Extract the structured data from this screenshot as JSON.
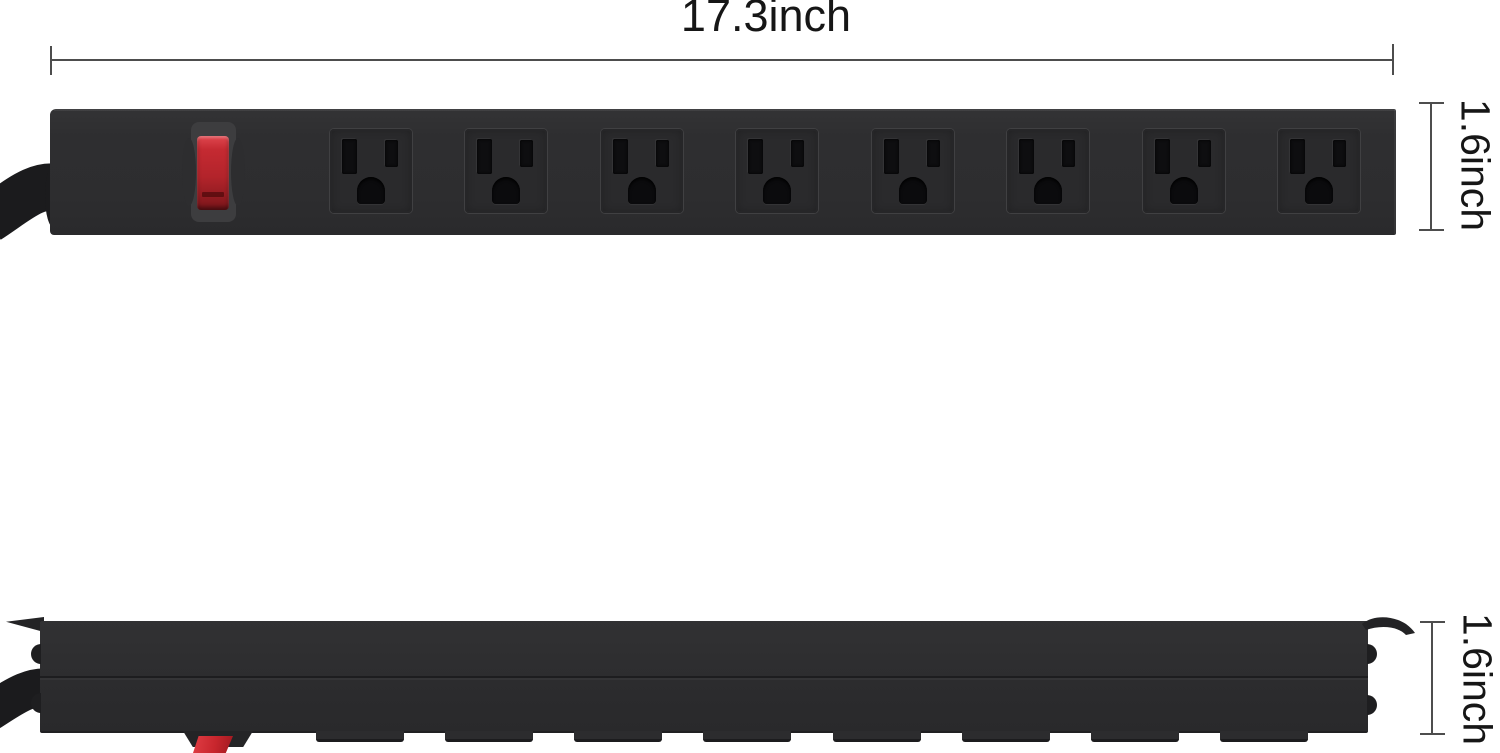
{
  "product": {
    "description": "black 8-outlet metal power strip, front view and bottom/side view",
    "outlet_count": 8,
    "views": [
      "front",
      "side"
    ]
  },
  "dimensions": {
    "width_label": "17.3inch",
    "height_label_front": "1.6inch",
    "height_label_side": "1.6inch"
  },
  "colors": {
    "background": "#ffffff",
    "strip_body": "#2d2d2f",
    "outlet_face": "#2a2a2c",
    "slot": "#0e0e10",
    "switch_red": "#c1272d",
    "switch_bezel": "#3d3d3f",
    "cord": "#1b1b1d",
    "dimension_line": "#4d4d4d",
    "dimension_text": "#161616"
  },
  "front_view": {
    "outlet_centers": [
      371,
      506,
      642,
      777,
      913,
      1048,
      1184,
      1319
    ]
  },
  "side_view": {
    "tab_centers": [
      360,
      489,
      618,
      747,
      877,
      1006,
      1135,
      1264
    ]
  }
}
